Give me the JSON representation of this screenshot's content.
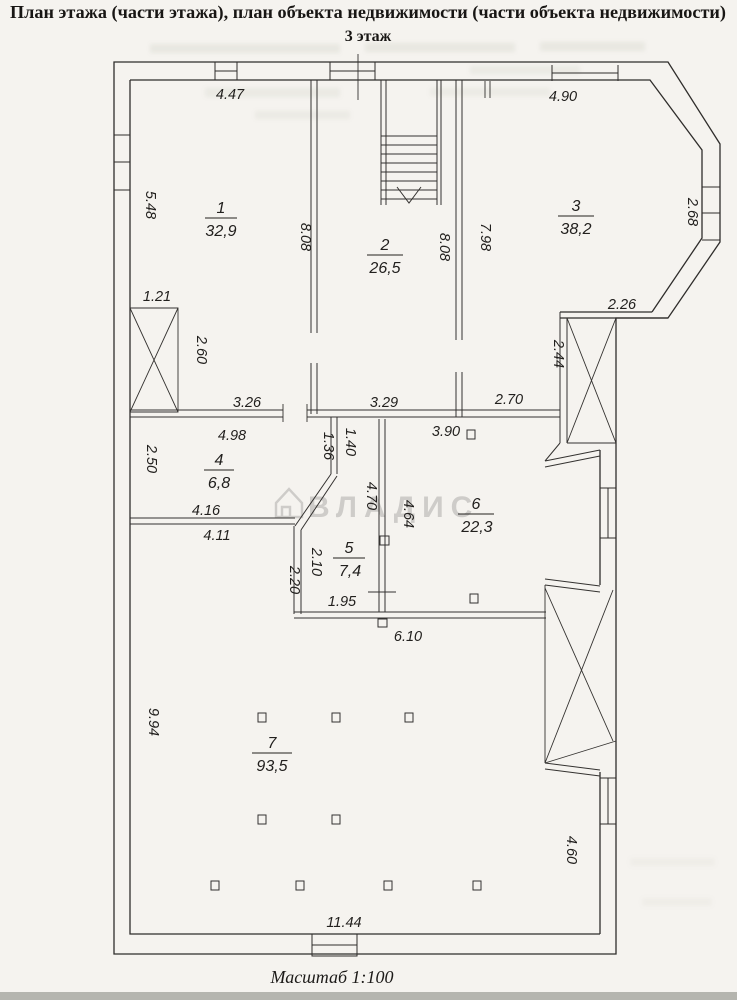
{
  "page": {
    "title": "План этажа (части этажа), план объекта недвижимости (части объекта недвижимости)",
    "floor_label": "3 этаж",
    "scale_label": "Масштаб 1:100",
    "watermark_text": "ВЛАДИС"
  },
  "rooms": [
    {
      "number": "1",
      "area": "32,9"
    },
    {
      "number": "2",
      "area": "26,5"
    },
    {
      "number": "3",
      "area": "38,2"
    },
    {
      "number": "4",
      "area": "6,8"
    },
    {
      "number": "5",
      "area": "7,4"
    },
    {
      "number": "6",
      "area": "22,3"
    },
    {
      "number": "7",
      "area": "93,5"
    }
  ],
  "dimensions": {
    "room1_top": "4.47",
    "bay_top": "4.90",
    "room1_left": "5.48",
    "wall_1_2": "8.08",
    "wall_2_3_left": "8.08",
    "wall_2_3_right": "7.98",
    "bay_right": "2.68",
    "shaft_top": "1.21",
    "shaft_right": "2.60",
    "bay_bottom": "2.26",
    "room3_right": "2.44",
    "room3_bottom": "2.70",
    "room1_bottom": "3.26",
    "room2_bottom": "3.29",
    "room6_top": "3.90",
    "room4_top": "4.98",
    "room4_left": "2.50",
    "stub_left": "1.36",
    "stub_right": "1.40",
    "room4_bottom_outer": "4.16",
    "room4_bottom_inner": "4.11",
    "wall_5_6_left": "4.70",
    "wall_5_6_right": "4.64",
    "room5_left_inner": "2.10",
    "room5_left_outer": "2.20",
    "room5_bottom": "1.95",
    "room6_bottom": "6.10",
    "room7_left": "9.94",
    "room7_right": "4.60",
    "room7_bottom": "11.44"
  }
}
